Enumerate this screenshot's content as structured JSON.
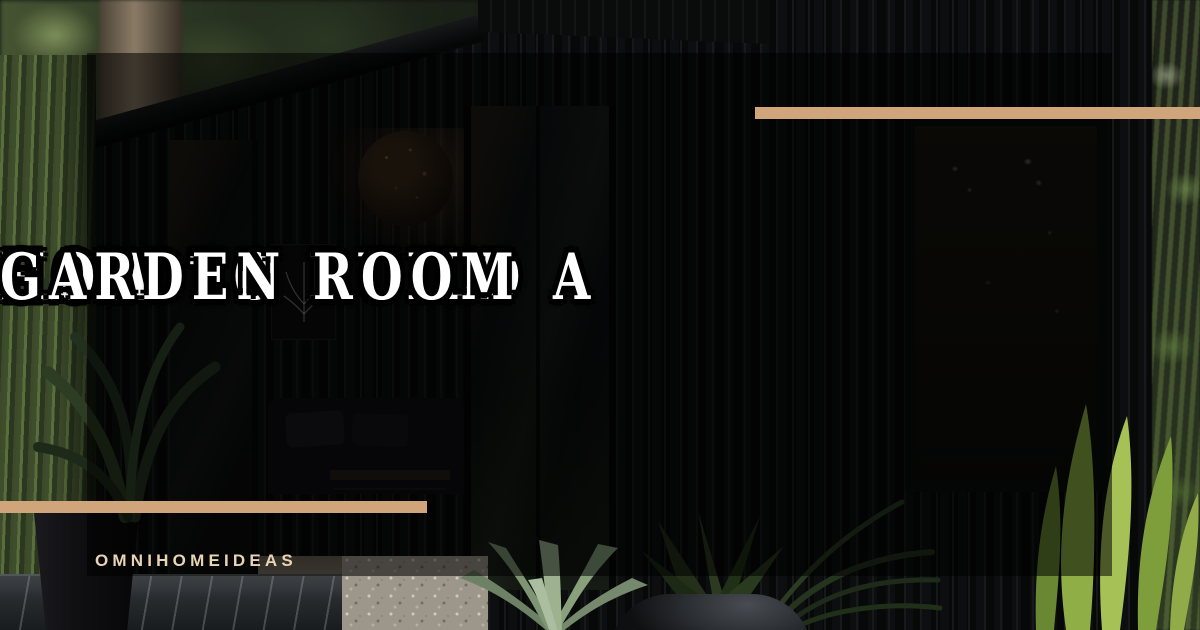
{
  "card": {
    "kind": "blog-featured-image",
    "title": {
      "line1": "HOW TO BUILD A",
      "line2": "GARDEN ROOM"
    },
    "watermark": "OMNIHOMEIDEAS"
  },
  "photo": {
    "alt": "Black timber garden room with glass doors and a warm wood interior, surrounded by green garden plants, agave and palm leaves"
  },
  "colors": {
    "accent_bar_tan": "#D1A57C",
    "watermark_cream": "#E8D4B4",
    "title_fill": "#FFFFFF",
    "title_outline": "#000000",
    "overlay_scrim": "rgba(0,0,0,0.54)"
  }
}
